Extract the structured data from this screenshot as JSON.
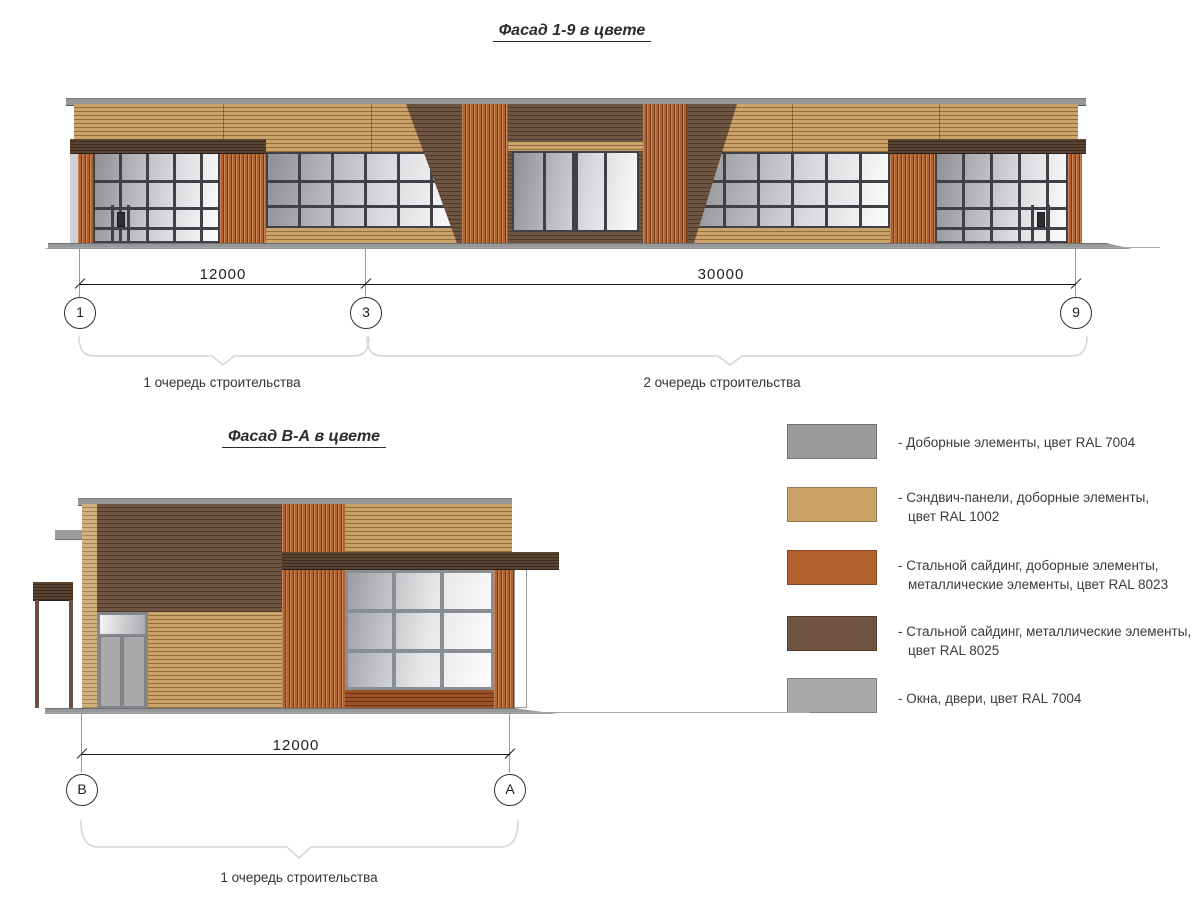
{
  "colors": {
    "ral7004": "#9a9a9c",
    "ral7004b": "#a8a9ab",
    "ral1002": "#cba368",
    "ral8023": "#b2622e",
    "ral8025": "#6f5442",
    "canopy_brown": "#5a4331",
    "orange_dark": "#9c5128",
    "roof_gray": "#97989a",
    "tan_light": "#d4b27f",
    "glass_dark": "#8e9094",
    "glass_light": "#fcfcfd",
    "frame_dark": "#3f4145",
    "frame_gray": "#8b8e91"
  },
  "facade19": {
    "title": "Фасад 1-9 в цвете",
    "axis_labels": [
      "1",
      "3",
      "9"
    ],
    "dim_labels": [
      "12000",
      "30000"
    ],
    "phase_labels": [
      "1 очередь строительства",
      "2 очередь строительства"
    ]
  },
  "facadeBA": {
    "title": "Фасад В-А в цвете",
    "axis_labels": [
      "В",
      "А"
    ],
    "dim_labels": [
      "12000"
    ],
    "phase_labels": [
      "1 очередь строительства"
    ]
  },
  "legend": {
    "items": [
      {
        "ral": "RAL 7004",
        "color": "#9a9a9c",
        "lines": [
          "- Доборные элементы, цвет RAL 7004"
        ]
      },
      {
        "ral": "RAL 1002",
        "color": "#cba368",
        "lines": [
          "- Сэндвич-панели, доборные элементы,",
          "цвет RAL 1002"
        ]
      },
      {
        "ral": "RAL 8023",
        "color": "#b2622e",
        "lines": [
          "- Стальной сайдинг, доборные элементы,",
          "металлические элементы, цвет RAL 8023"
        ]
      },
      {
        "ral": "RAL 8025",
        "color": "#6f5442",
        "lines": [
          "- Стальной сайдинг, металлические элементы,",
          "цвет RAL 8025"
        ]
      },
      {
        "ral": "RAL 7004",
        "color": "#a8a9ab",
        "lines": [
          "- Окна, двери, цвет RAL 7004"
        ]
      }
    ]
  }
}
